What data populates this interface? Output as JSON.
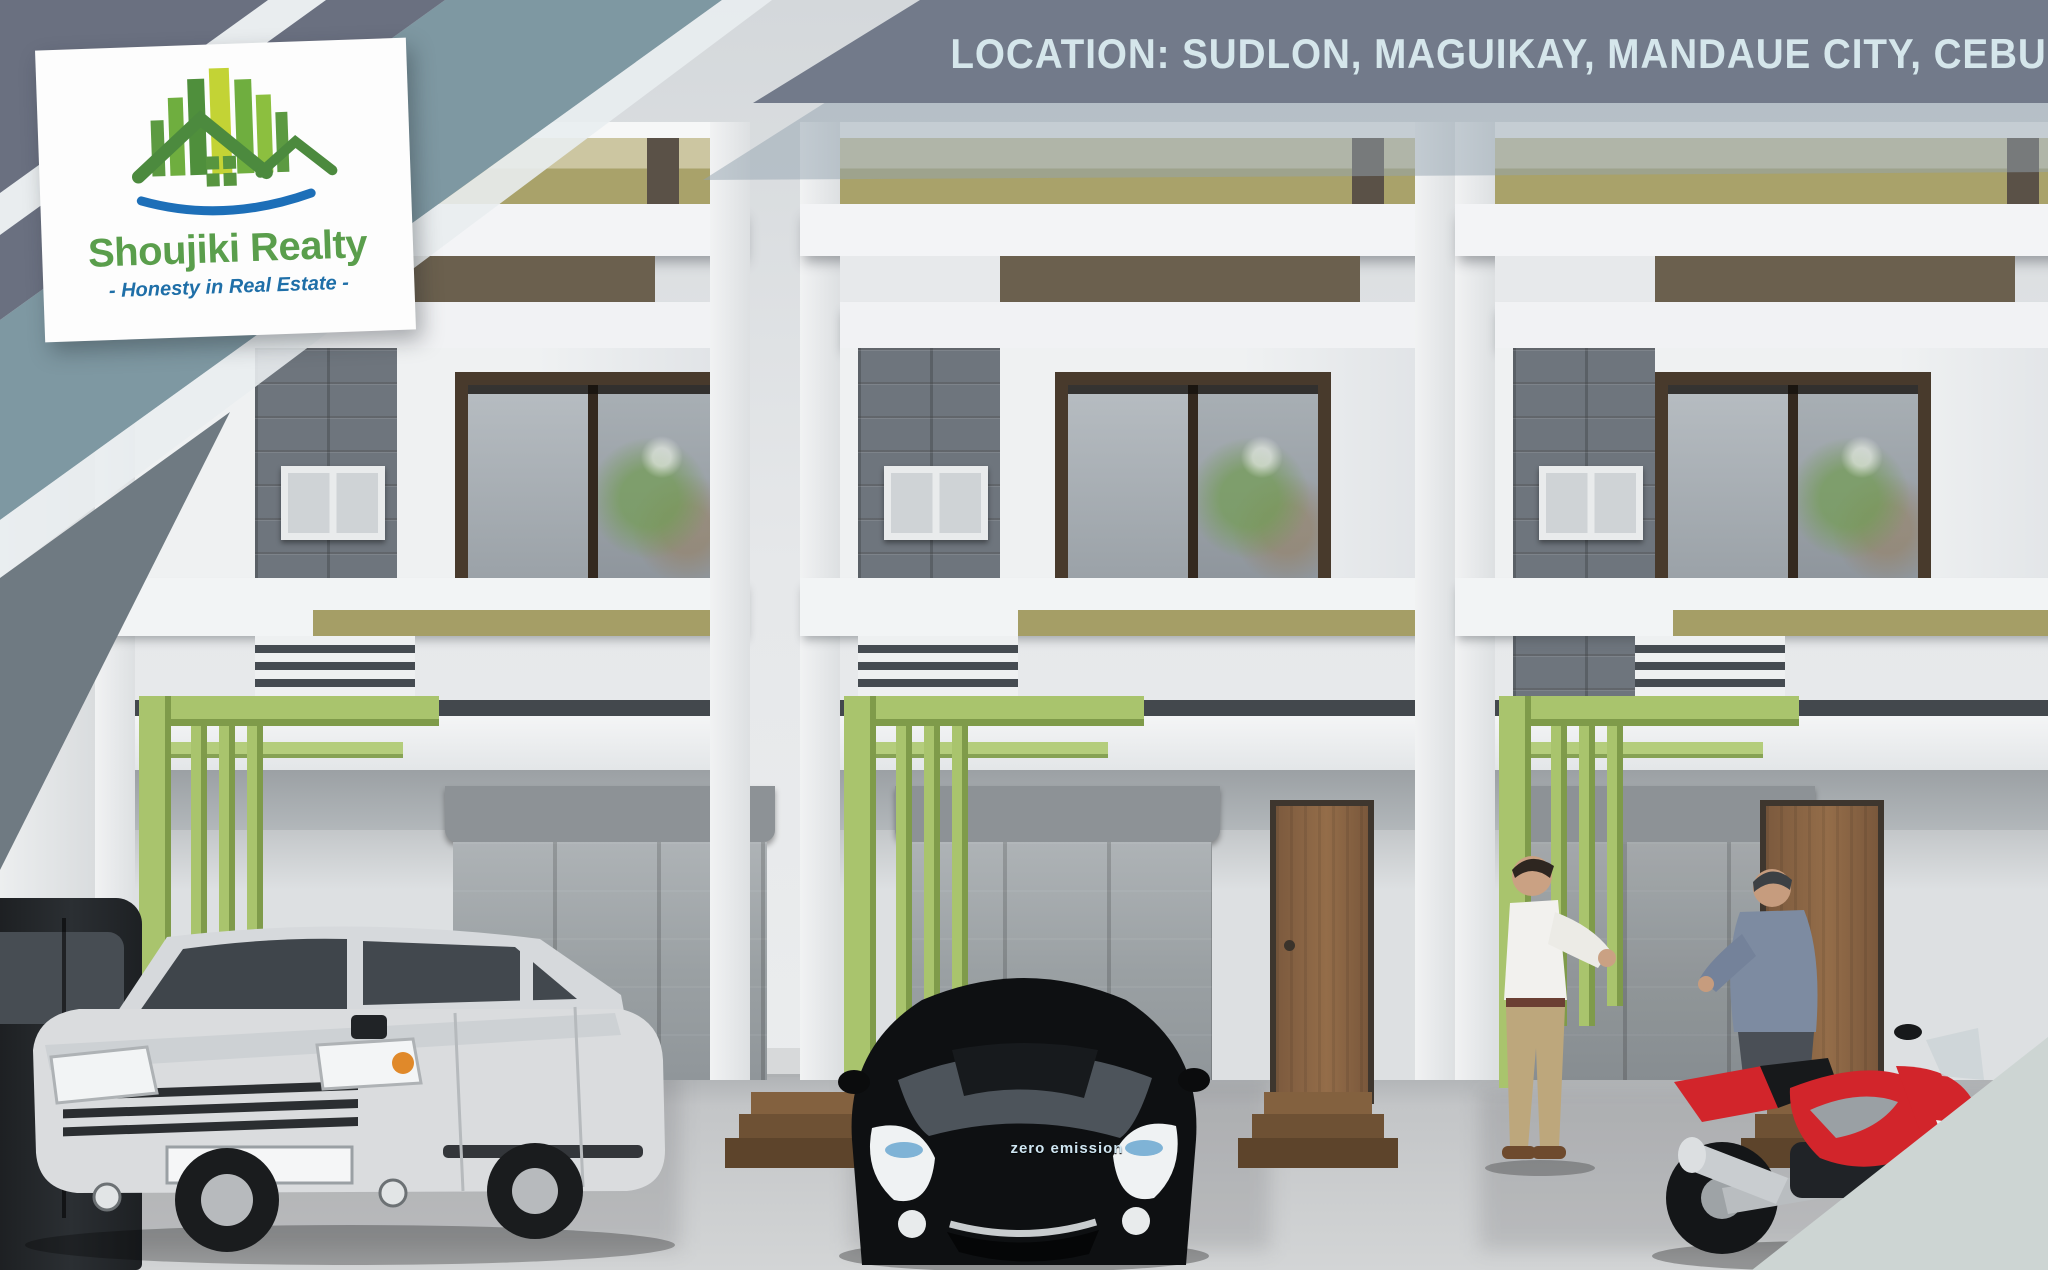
{
  "banner": {
    "location_label": "LOCATION: SUDLON, MAGUIKAY, MANDAUE CITY, CEBU"
  },
  "logo": {
    "name": "Shoujiki Realty",
    "tagline": "- Honesty in Real Estate -",
    "icon": "green-buildings-house-swoosh-icon"
  },
  "vehicles": {
    "ev_badge_label": "zero emission"
  },
  "palette": {
    "ribbon_dark": "#6a7080",
    "ribbon_teal": "#7e98a2",
    "ribbon_light": "#e9edef",
    "banner_bg": "#727a8a",
    "banner_text": "#d5e6eb",
    "logo_green": "#5a9e4c",
    "logo_blue": "#1f6fa8",
    "parapet_olive": "#a9a26a",
    "pergola_green": "#a9c46d",
    "fascia_brown": "#6b604e",
    "door_brown": "#8a6546",
    "motorcycle_red": "#d2252b",
    "suv_silver": "#dadcde",
    "ev_car_black": "#0e1012"
  }
}
